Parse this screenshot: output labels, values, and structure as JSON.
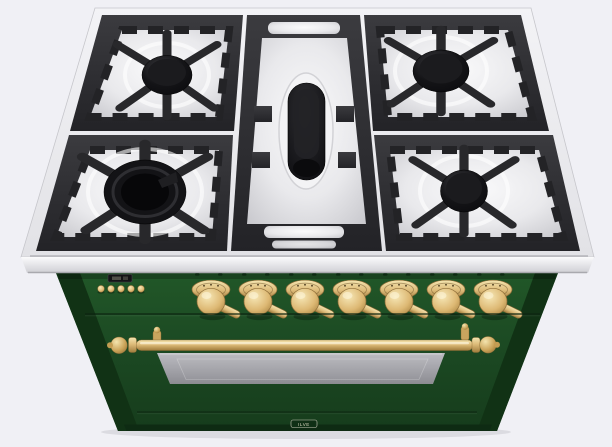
{
  "scene": {
    "type": "3d-product-render",
    "subject": "freestanding 5-burner gas range with oven",
    "finish": "emerald green with brass trim",
    "view": "overhead front three-quarter"
  },
  "cooktop": {
    "surface": "stainless steel with white enamel burner bowls",
    "grates": "black cast iron",
    "burners": [
      {
        "position": "rear-left",
        "type": "round gas burner",
        "size": "medium"
      },
      {
        "position": "front-left",
        "type": "triple-ring gas burner",
        "size": "large"
      },
      {
        "position": "center",
        "type": "oval fish burner",
        "size": "oval"
      },
      {
        "position": "rear-right",
        "type": "round gas burner",
        "size": "medium"
      },
      {
        "position": "front-right",
        "type": "round gas burner",
        "size": "medium"
      }
    ]
  },
  "control_panel": {
    "clock_display": {
      "type": "digital-clock",
      "text": ""
    },
    "button_count": 5,
    "knob_count": 7,
    "knob_finish": "brass"
  },
  "oven_door": {
    "handle": "brass rail handle with ball finials",
    "window": "tinted glass viewing window"
  },
  "brand_badge": {
    "label": "ILVE"
  },
  "colors": {
    "background": "#f0f0f5",
    "steel_light": "#f3f3f6",
    "steel": "#e2e2e6",
    "steel_shadow": "#cfcfd4",
    "enamel_light": "#fafafb",
    "enamel": "#e9e9ec",
    "enamel_shadow": "#c7c7cc",
    "grate_light": "#3b3b3f",
    "grate": "#232327",
    "burner_black": "#0b0b0e",
    "green_top": "#215728",
    "green_mid": "#1c4a23",
    "green_bottom": "#163c1c",
    "green_side": "#113215",
    "brass_light": "#f4e5b0",
    "brass": "#ddbb79",
    "brass_dark": "#a07c3c",
    "glass_light": "#bcbcc2",
    "glass_dark": "#8c8c92",
    "display_black": "#141416"
  }
}
